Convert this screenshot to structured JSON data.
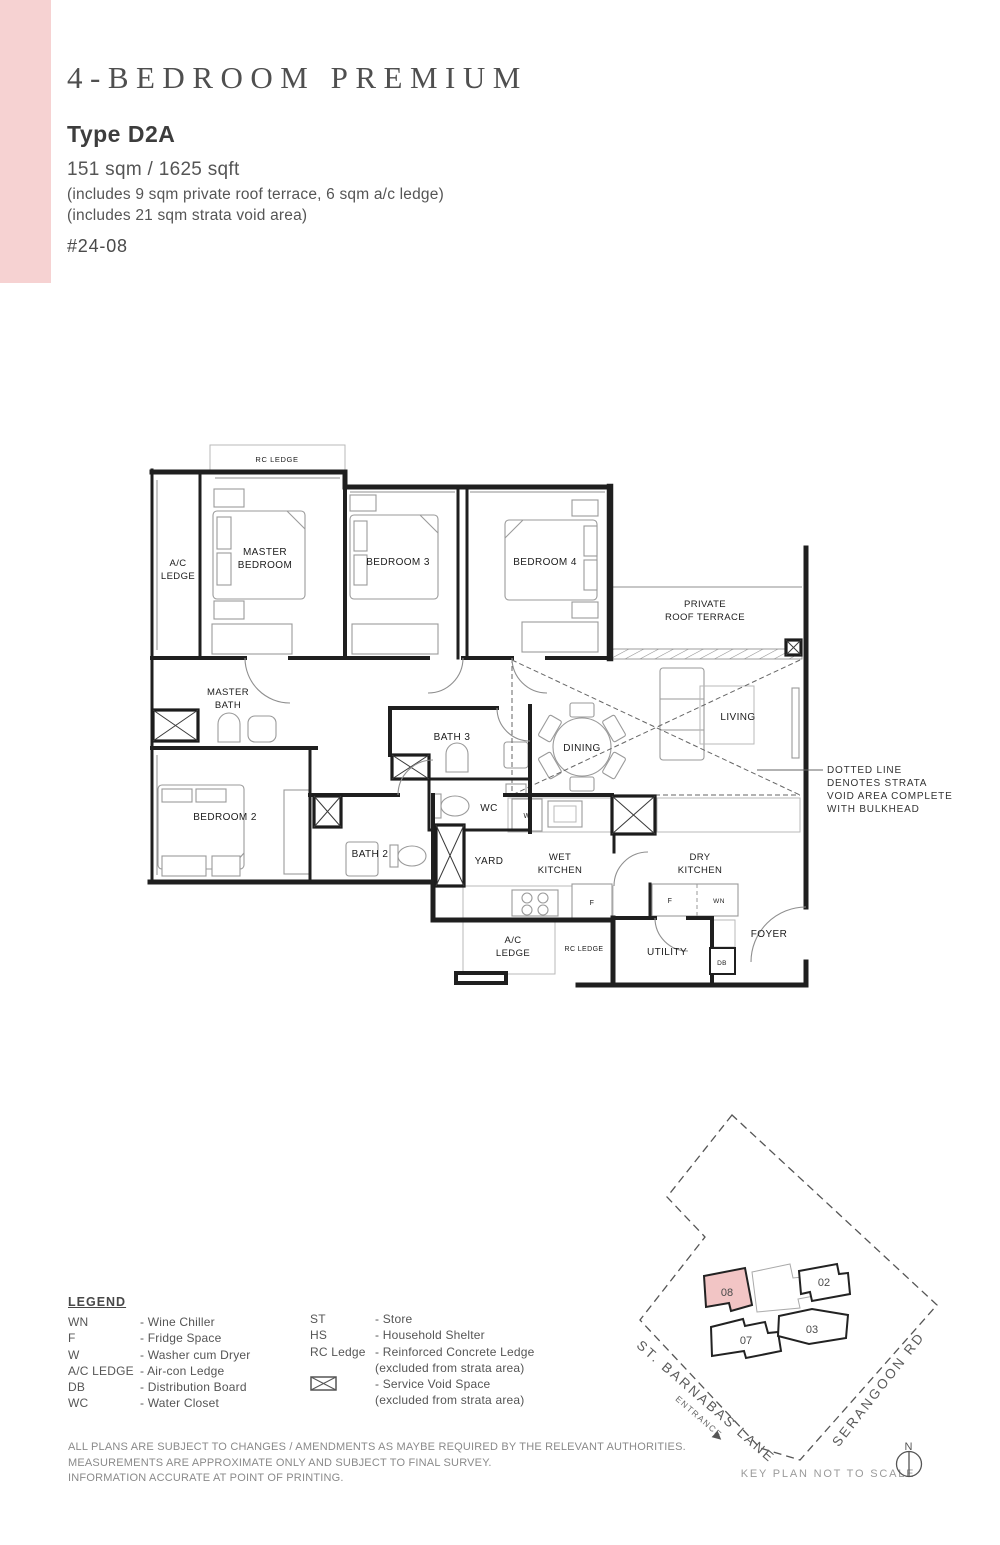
{
  "colors": {
    "accent_pink": "#f6d2d2",
    "keyplan_highlight": "#f2c5c5"
  },
  "header": {
    "title": "4-BEDROOM PREMIUM",
    "unit_type": "Type D2A",
    "area": "151 sqm / 1625 sqft",
    "area_note_1": "(includes 9 sqm private roof terrace, 6 sqm a/c ledge)",
    "area_note_2": "(includes 21 sqm strata void area)",
    "unit_no": "#24-08"
  },
  "plan": {
    "rooms": {
      "rc_ledge_top": "RC LEDGE",
      "ac_ledge": [
        "A/C",
        "LEDGE"
      ],
      "master_bedroom": [
        "MASTER",
        "BEDROOM"
      ],
      "bedroom3": "BEDROOM 3",
      "bedroom4": "BEDROOM 4",
      "terrace": [
        "PRIVATE",
        "ROOF TERRACE"
      ],
      "master_bath": [
        "MASTER",
        "BATH"
      ],
      "bath3": "BATH 3",
      "dining": "DINING",
      "living": "LIVING",
      "bedroom2": "BEDROOM 2",
      "bath2": "BATH 2",
      "wc": "WC",
      "yard": "YARD",
      "wet_kitchen": [
        "WET",
        "KITCHEN"
      ],
      "dry_kitchen": [
        "DRY",
        "KITCHEN"
      ],
      "ac_ledge_bottom": [
        "A/C",
        "LEDGE"
      ],
      "rc_ledge_bottom": "RC LEDGE",
      "utility": "UTILITY",
      "foyer": "FOYER",
      "db": "DB",
      "fridge": "F",
      "wine_chiller": "WN",
      "washer": "W"
    },
    "void_note": [
      "DOTTED LINE",
      "DENOTES STRATA",
      "VOID AREA COMPLETE",
      "WITH BULKHEAD"
    ]
  },
  "legend": {
    "title": "LEGEND",
    "left": [
      {
        "abbr": "WN",
        "desc": "- Wine Chiller"
      },
      {
        "abbr": "F",
        "desc": "- Fridge Space"
      },
      {
        "abbr": "W",
        "desc": "- Washer cum Dryer"
      },
      {
        "abbr": "A/C LEDGE",
        "desc": "- Air-con Ledge"
      },
      {
        "abbr": "DB",
        "desc": "- Distribution Board"
      },
      {
        "abbr": "WC",
        "desc": "- Water Closet"
      }
    ],
    "right": [
      {
        "abbr": "ST",
        "desc": "- Store"
      },
      {
        "abbr": "HS",
        "desc": "- Household Shelter"
      },
      {
        "abbr": "RC Ledge",
        "desc": "- Reinforced Concrete Ledge",
        "desc2": "(excluded from strata area)"
      },
      {
        "abbr": "service-void-icon",
        "desc": "- Service Void Space",
        "desc2": "(excluded from strata area)"
      }
    ]
  },
  "key_plan": {
    "units": [
      {
        "id": "08"
      },
      {
        "id": "02"
      },
      {
        "id": "07"
      },
      {
        "id": "03"
      }
    ],
    "highlighted_unit": "08",
    "road_1": "ST. BARNABAS LANE",
    "entrance": "ENTRANCE",
    "road_2": "SERANGOON RD",
    "north": "N",
    "note": "KEY PLAN NOT TO SCALE"
  },
  "disclaimer": [
    "ALL PLANS ARE SUBJECT TO CHANGES / AMENDMENTS AS MAYBE REQUIRED BY THE RELEVANT AUTHORITIES.",
    "MEASUREMENTS ARE APPROXIMATE ONLY AND SUBJECT TO FINAL SURVEY.",
    "INFORMATION ACCURATE AT POINT OF PRINTING."
  ]
}
